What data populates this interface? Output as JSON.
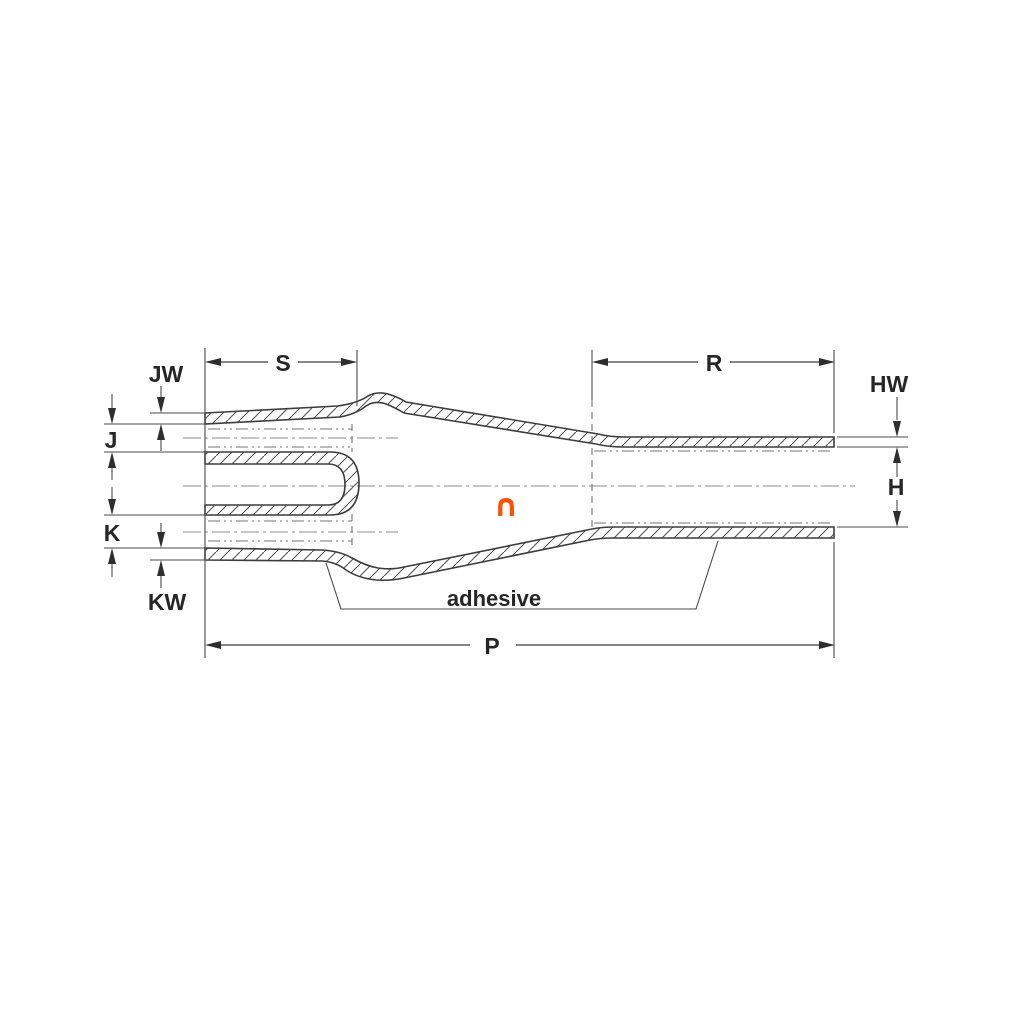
{
  "drawing": {
    "kind": "transition-boot-cross-section",
    "dimension_labels": {
      "jw": "JW",
      "j": "J",
      "k": "K",
      "kw": "KW",
      "s": "S",
      "r": "R",
      "hw": "HW",
      "h": "H",
      "p": "P"
    },
    "annotations": {
      "adhesive": "adhesive"
    },
    "icons": {
      "intersection": {
        "name": "intersection-icon",
        "glyph": "∩",
        "color": "#ff5104"
      }
    },
    "colors": {
      "background": "#ffffff",
      "line": "#3d3d3d",
      "text": "#262626",
      "hatch": "#565656",
      "construction": "#767676",
      "centerline": "#8d8d8d",
      "accent_orange": "#ff5104"
    }
  }
}
